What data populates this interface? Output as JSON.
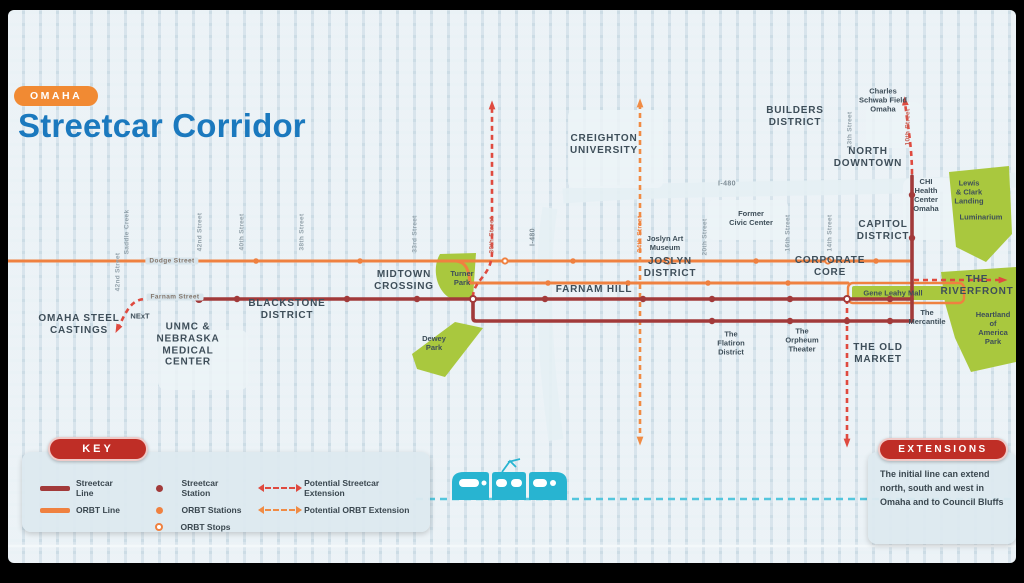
{
  "colors": {
    "streetcar": "#a23a3a",
    "orbt": "#ef8140",
    "ext_streetcar": "#df4a3f",
    "ext_orbt": "#f08b44",
    "river": "#54c6dd",
    "park": "#a9c83e",
    "tram": "#28b4d1",
    "title_blue": "#1b79be",
    "badge_orange": "#f18a33",
    "badge_red": "#bf2e26",
    "label_dark": "#3e4e59",
    "street_gray": "#93a2ab"
  },
  "header": {
    "badge": "OMAHA",
    "title": "Streetcar Corridor"
  },
  "key": {
    "title": "KEY",
    "lines": [
      {
        "label": "Streetcar Line",
        "color_key": "streetcar"
      },
      {
        "label": "ORBT Line",
        "color_key": "orbt"
      }
    ],
    "stations": [
      {
        "label": "Streetcar Station",
        "style": "dot",
        "color_key": "streetcar"
      },
      {
        "label": "ORBT Stations",
        "style": "dot",
        "color_key": "orbt"
      },
      {
        "label": "ORBT Stops",
        "style": "ring",
        "color_key": "orbt"
      }
    ],
    "extensions": [
      {
        "label": "Potential Streetcar Extension",
        "color_key": "ext_streetcar"
      },
      {
        "label": "Potential ORBT Extension",
        "color_key": "ext_orbt"
      }
    ]
  },
  "extensions_box": {
    "title": "EXTENSIONS",
    "text": "The initial line can extend north, south and west in Omaha and to Council Bluffs"
  },
  "map": {
    "districts": [
      {
        "label": "CREIGHTON\nUNIVERSITY",
        "x": 596,
        "y": 135
      },
      {
        "label": "BUILDERS\nDISTRICT",
        "x": 787,
        "y": 107
      },
      {
        "label": "NORTH\nDOWNTOWN",
        "x": 860,
        "y": 148
      },
      {
        "label": "CAPITOL\nDISTRICT",
        "x": 875,
        "y": 221
      },
      {
        "label": "JOSLYN\nDISTRICT",
        "x": 662,
        "y": 258
      },
      {
        "label": "CORPORATE\nCORE",
        "x": 822,
        "y": 257
      },
      {
        "label": "MIDTOWN\nCROSSING",
        "x": 396,
        "y": 271
      },
      {
        "label": "FARNAM HILL",
        "x": 586,
        "y": 280
      },
      {
        "label": "BLACKSTONE\nDISTRICT",
        "x": 279,
        "y": 300
      },
      {
        "label": "OMAHA STEEL\nCASTINGS",
        "x": 71,
        "y": 315
      },
      {
        "label": "UNMC &\nNEBRASKA\nMEDICAL\nCENTER",
        "x": 180,
        "y": 335
      },
      {
        "label": "THE OLD\nMARKET",
        "x": 870,
        "y": 344
      },
      {
        "label": "THE\nRIVERFRONT",
        "x": 969,
        "y": 276
      }
    ],
    "places": [
      {
        "label": "Charles\nSchwab Field\nOmaha",
        "x": 875,
        "y": 90
      },
      {
        "label": "CHI\nHealth\nCenter\nOmaha",
        "x": 918,
        "y": 185
      },
      {
        "label": "Lewis\n& Clark\nLanding",
        "x": 961,
        "y": 182
      },
      {
        "label": "Luminarium",
        "x": 973,
        "y": 207
      },
      {
        "label": "Former\nCivic Center",
        "x": 743,
        "y": 208
      },
      {
        "label": "Joslyn Art\nMuseum",
        "x": 657,
        "y": 233
      },
      {
        "label": "Turner\nPark",
        "x": 454,
        "y": 268
      },
      {
        "label": "Dewey\nPark",
        "x": 426,
        "y": 333
      },
      {
        "label": "Gene Leahy Mall",
        "x": 885,
        "y": 283
      },
      {
        "label": "The\nMercantile",
        "x": 919,
        "y": 307
      },
      {
        "label": "The\nFlatiron\nDistrict",
        "x": 723,
        "y": 333
      },
      {
        "label": "The\nOrpheum\nTheater",
        "x": 794,
        "y": 330
      },
      {
        "label": "Heartland\nof America\nPark",
        "x": 985,
        "y": 318
      },
      {
        "label": "NExT",
        "x": 132,
        "y": 306
      }
    ],
    "streets": [
      {
        "label": "Saddle Creek",
        "x": 119,
        "y": 222
      },
      {
        "label": "42nd Street",
        "x": 192,
        "y": 222
      },
      {
        "label": "40th Street",
        "x": 234,
        "y": 222
      },
      {
        "label": "38th Street",
        "x": 294,
        "y": 222
      },
      {
        "label": "42nd Street",
        "x": 110,
        "y": 262
      },
      {
        "label": "33rd Street",
        "x": 407,
        "y": 224
      },
      {
        "label": "30th Street",
        "x": 484,
        "y": 225,
        "color": "#c96055"
      },
      {
        "label": "24th Street",
        "x": 632,
        "y": 224,
        "color": "#ef8140"
      },
      {
        "label": "20th Street",
        "x": 697,
        "y": 227
      },
      {
        "label": "16th Street",
        "x": 780,
        "y": 223
      },
      {
        "label": "14th Street",
        "x": 822,
        "y": 223
      },
      {
        "label": "13th Street",
        "x": 842,
        "y": 120
      },
      {
        "label": "10th Street",
        "x": 900,
        "y": 117,
        "color": "#c96055"
      }
    ],
    "roads": [
      {
        "label": "Dodge Street",
        "x": 164,
        "y": 251,
        "gap": true
      },
      {
        "label": "Farnam Street",
        "x": 167,
        "y": 287,
        "gap": true
      },
      {
        "label": "I-480",
        "x": 719,
        "y": 174,
        "i480": true
      },
      {
        "label": "I-480",
        "x": 525,
        "y": 227,
        "vertical": true,
        "i480": true
      }
    ]
  }
}
